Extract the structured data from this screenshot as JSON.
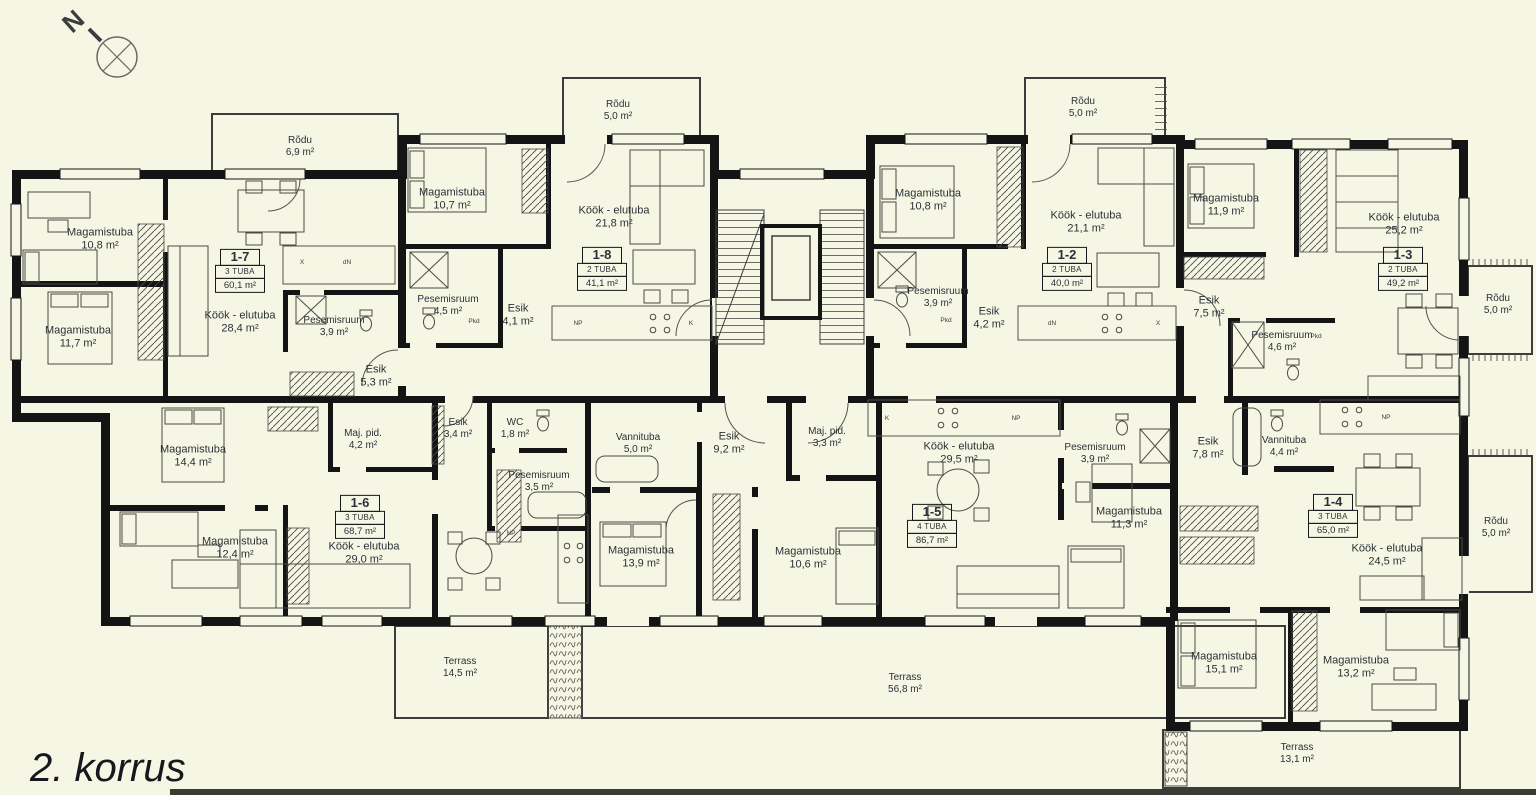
{
  "title": "2. korrus",
  "compass": {
    "label": "N"
  },
  "colors": {
    "background": "#f5f6e3",
    "wall": "#141414",
    "text": "#2a3138"
  },
  "apartments": [
    {
      "id": "1-7",
      "type": "3 TUBA",
      "area": "60,1 m²",
      "rooms": [
        {
          "name": "Magamistuba",
          "area": "10,8 m²"
        },
        {
          "name": "Magamistuba",
          "area": "11,7 m²"
        },
        {
          "name": "Köök - elutuba",
          "area": "28,4 m²"
        },
        {
          "name": "Pesemisruum",
          "area": "3,9 m²"
        },
        {
          "name": "Esik",
          "area": "5,3 m²"
        }
      ]
    },
    {
      "id": "1-8",
      "type": "2 TUBA",
      "area": "41,1 m²",
      "rooms": [
        {
          "name": "Magamistuba",
          "area": "10,7 m²"
        },
        {
          "name": "Köök - elutuba",
          "area": "21,8 m²"
        },
        {
          "name": "Pesemisruum",
          "area": "4,5 m²"
        },
        {
          "name": "Esik",
          "area": "4,1 m²"
        }
      ]
    },
    {
      "id": "1-2",
      "type": "2 TUBA",
      "area": "40,0 m²",
      "rooms": [
        {
          "name": "Magamistuba",
          "area": "10,8 m²"
        },
        {
          "name": "Köök - elutuba",
          "area": "21,1 m²"
        },
        {
          "name": "Pesemisruum",
          "area": "3,9 m²"
        },
        {
          "name": "Esik",
          "area": "4,2 m²"
        }
      ]
    },
    {
      "id": "1-3",
      "type": "2 TUBA",
      "area": "49,2 m²",
      "rooms": [
        {
          "name": "Magamistuba",
          "area": "11,9 m²"
        },
        {
          "name": "Köök - elutuba",
          "area": "25,2 m²"
        },
        {
          "name": "Esik",
          "area": "7,5 m²"
        },
        {
          "name": "Pesemisruum",
          "area": "4,6 m²"
        }
      ]
    },
    {
      "id": "1-6",
      "type": "3 TUBA",
      "area": "68,7 m²",
      "rooms": [
        {
          "name": "Magamistuba",
          "area": "14,4 m²"
        },
        {
          "name": "Magamistuba",
          "area": "12,4 m²"
        },
        {
          "name": "Maj. pid.",
          "area": "4,2 m²"
        },
        {
          "name": "Köök - elutuba",
          "area": "29,0 m²"
        },
        {
          "name": "Esik",
          "area": "3,4 m²"
        },
        {
          "name": "WC",
          "area": "1,8 m²"
        },
        {
          "name": "Pesemisruum",
          "area": "3,5 m²"
        }
      ]
    },
    {
      "id": "1-5",
      "type": "4 TUBA",
      "area": "86,7 m²",
      "rooms": [
        {
          "name": "Maj. pid.",
          "area": "3,3 m²"
        },
        {
          "name": "Köök - elutuba",
          "area": "29,5 m²"
        },
        {
          "name": "Vannituba",
          "area": "5,0 m²"
        },
        {
          "name": "Esik",
          "area": "9,2 m²"
        },
        {
          "name": "Magamistuba",
          "area": "13,9 m²"
        },
        {
          "name": "Magamistuba",
          "area": "10,6 m²"
        },
        {
          "name": "Pesemisruum",
          "area": "3,9 m²"
        },
        {
          "name": "Magamistuba",
          "area": "11,3 m²"
        }
      ]
    },
    {
      "id": "1-4",
      "type": "3 TUBA",
      "area": "65,0 m²",
      "rooms": [
        {
          "name": "Esik",
          "area": "7,8 m²"
        },
        {
          "name": "Vannituba",
          "area": "4,4 m²"
        },
        {
          "name": "Köök - elutuba",
          "area": "24,5 m²"
        },
        {
          "name": "Magamistuba",
          "area": "15,1 m²"
        },
        {
          "name": "Magamistuba",
          "area": "13,2 m²"
        }
      ]
    }
  ],
  "outdoor": [
    {
      "name": "Rõdu",
      "area": "6,9 m²"
    },
    {
      "name": "Rõdu",
      "area": "5,0 m²"
    },
    {
      "name": "Rõdu",
      "area": "5,0 m²"
    },
    {
      "name": "Rõdu",
      "area": "5,0 m²"
    },
    {
      "name": "Rõdu",
      "area": "5,0 m²"
    },
    {
      "name": "Terrass",
      "area": "14,5 m²"
    },
    {
      "name": "Terrass",
      "area": "56,8 m²"
    },
    {
      "name": "Terrass",
      "area": "13,1 m²"
    }
  ],
  "fixtures": [
    {
      "label": "X"
    },
    {
      "label": "dN"
    },
    {
      "label": "NP"
    },
    {
      "label": "K"
    },
    {
      "label": "Pkd"
    },
    {
      "label": "dN"
    },
    {
      "label": "X"
    },
    {
      "label": "Pkd"
    },
    {
      "label": "Pkd"
    },
    {
      "label": "K"
    },
    {
      "label": "NP"
    },
    {
      "label": "NP"
    },
    {
      "label": "NP"
    }
  ],
  "symbols": {
    "north-compass-icon": "circle with inscribed cross and N needle",
    "bed-symbol": "rectangle with pillow",
    "sofa-symbol": "L-shaped outline",
    "dining-table-symbol": "table with chairs",
    "bathtub-symbol": "rounded rectangle",
    "toilet-symbol": "ellipse with tank",
    "shower-symbol": "square with diagonals",
    "wardrobe-hatch": "diagonal hatching strip",
    "stairs-symbol": "tread lines",
    "elevator-symbol": "double rectangle",
    "plant-box-symbol": "squiggle-filled box"
  }
}
